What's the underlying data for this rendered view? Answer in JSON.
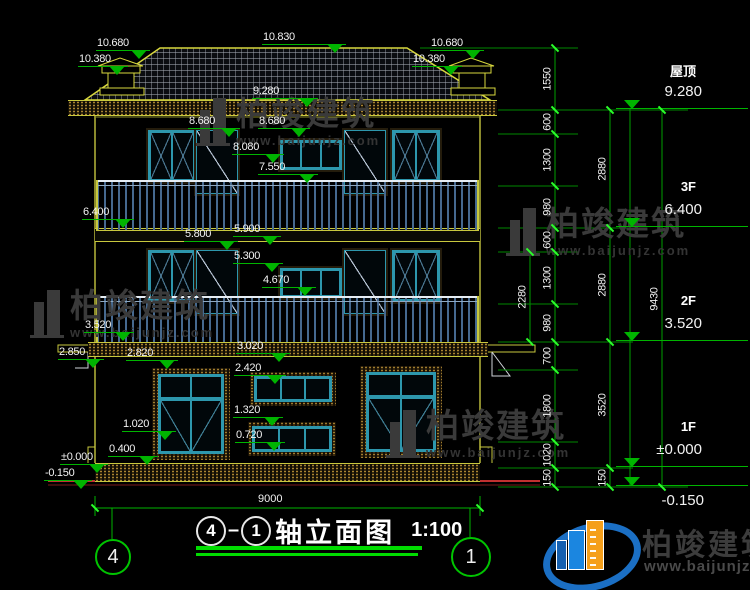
{
  "meta": {
    "drawing_type": "building elevation CAD drawing",
    "axis_from": "4",
    "axis_to": "1",
    "title_text": "轴立面图",
    "scale": "1:100",
    "bottom_overall_dim": "9000"
  },
  "colors": {
    "background": "#000000",
    "cad_yellow": "#d8d83e",
    "dim_green": "#00b400",
    "bright_green": "#2bff2b",
    "underline_green": "#00dc00",
    "window_teal": "#2d97ad",
    "rail_blue": "#46698f",
    "ground_red": "#c23030",
    "watermark_gray": "#3a3a3a",
    "logo_blue": "#1b6fc4",
    "logo_orange": "#f59f1a"
  },
  "watermark": {
    "brand": "柏竣建筑",
    "url": "www.baijunjz.com"
  },
  "logo": {
    "brand": "柏竣建筑",
    "url": "www.baijunjz.com"
  },
  "right_levels": [
    {
      "name": "屋顶",
      "value": "9.280",
      "below": "",
      "x": 616,
      "y": 108
    },
    {
      "name": "3F",
      "value": "6.400",
      "below": "",
      "x": 616,
      "y": 226
    },
    {
      "name": "2F",
      "value": "3.520",
      "below": "",
      "x": 616,
      "y": 340
    },
    {
      "name": "1F",
      "value": "±0.000",
      "below": "",
      "x": 616,
      "y": 466
    },
    {
      "name": "",
      "value": "",
      "below": "-0.150",
      "x": 616,
      "y": 485
    }
  ],
  "facade_markers": [
    {
      "label": "10.680",
      "x": 96,
      "y": 50,
      "w": 54
    },
    {
      "label": "10.380",
      "x": 78,
      "y": 66,
      "w": 50
    },
    {
      "label": "10.830",
      "x": 262,
      "y": 44,
      "w": 84
    },
    {
      "label": "10.680",
      "x": 430,
      "y": 50,
      "w": 54
    },
    {
      "label": "10.380",
      "x": 412,
      "y": 66,
      "w": 50
    },
    {
      "label": "9.280",
      "x": 252,
      "y": 98,
      "w": 66
    },
    {
      "label": "8.680",
      "x": 188,
      "y": 128,
      "w": 52
    },
    {
      "label": "8.680",
      "x": 258,
      "y": 128,
      "w": 52
    },
    {
      "label": "8.080",
      "x": 232,
      "y": 154,
      "w": 52
    },
    {
      "label": "7.550",
      "x": 258,
      "y": 174,
      "w": 60
    },
    {
      "label": "6.400",
      "x": 82,
      "y": 219,
      "w": 52
    },
    {
      "label": "5.800",
      "x": 184,
      "y": 241,
      "w": 54
    },
    {
      "label": "5.900",
      "x": 233,
      "y": 236,
      "w": 48
    },
    {
      "label": "5.300",
      "x": 233,
      "y": 263,
      "w": 50
    },
    {
      "label": "4.670",
      "x": 262,
      "y": 287,
      "w": 54
    },
    {
      "label": "3.520",
      "x": 84,
      "y": 332,
      "w": 50
    },
    {
      "label": "2.850",
      "x": 58,
      "y": 359,
      "w": 46
    },
    {
      "label": "2.820",
      "x": 126,
      "y": 360,
      "w": 52
    },
    {
      "label": "3.020",
      "x": 236,
      "y": 353,
      "w": 54
    },
    {
      "label": "2.420",
      "x": 234,
      "y": 375,
      "w": 52
    },
    {
      "label": "1.020",
      "x": 122,
      "y": 431,
      "w": 54
    },
    {
      "label": "1.320",
      "x": 233,
      "y": 417,
      "w": 50
    },
    {
      "label": "0.720",
      "x": 235,
      "y": 442,
      "w": 50
    },
    {
      "label": "0.400",
      "x": 108,
      "y": 456,
      "w": 50
    },
    {
      "label": "±0.000",
      "x": 60,
      "y": 464,
      "w": 48
    },
    {
      "label": "-0.150",
      "x": 44,
      "y": 480,
      "w": 48
    }
  ],
  "dim_segments": [
    {
      "label": "1550",
      "x": 541,
      "y": 48,
      "h": 62
    },
    {
      "label": "600",
      "x": 541,
      "y": 110,
      "h": 24
    },
    {
      "label": "1300",
      "x": 541,
      "y": 134,
      "h": 52
    },
    {
      "label": "980",
      "x": 541,
      "y": 186,
      "h": 42
    },
    {
      "label": "600",
      "x": 541,
      "y": 228,
      "h": 24
    },
    {
      "label": "1300",
      "x": 541,
      "y": 252,
      "h": 52
    },
    {
      "label": "980",
      "x": 541,
      "y": 304,
      "h": 38
    },
    {
      "label": "700",
      "x": 541,
      "y": 342,
      "h": 28
    },
    {
      "label": "1800",
      "x": 541,
      "y": 370,
      "h": 72
    },
    {
      "label": "1020",
      "x": 541,
      "y": 442,
      "h": 26
    },
    {
      "label": "150",
      "x": 541,
      "y": 468,
      "h": 19
    },
    {
      "label": "2880",
      "x": 596,
      "y": 110,
      "h": 118
    },
    {
      "label": "2880",
      "x": 596,
      "y": 228,
      "h": 114
    },
    {
      "label": "3520",
      "x": 596,
      "y": 342,
      "h": 126
    },
    {
      "label": "150",
      "x": 596,
      "y": 468,
      "h": 19
    },
    {
      "label": "9430",
      "x": 648,
      "y": 110,
      "h": 377
    },
    {
      "label": "2280",
      "x": 516,
      "y": 252,
      "h": 90
    }
  ],
  "dim_ticks": [
    {
      "x": 555,
      "y": 48
    },
    {
      "x": 555,
      "y": 110
    },
    {
      "x": 555,
      "y": 134
    },
    {
      "x": 555,
      "y": 186
    },
    {
      "x": 555,
      "y": 228
    },
    {
      "x": 555,
      "y": 252
    },
    {
      "x": 555,
      "y": 304
    },
    {
      "x": 555,
      "y": 342
    },
    {
      "x": 555,
      "y": 370
    },
    {
      "x": 555,
      "y": 442
    },
    {
      "x": 555,
      "y": 468
    },
    {
      "x": 555,
      "y": 487
    },
    {
      "x": 610,
      "y": 110
    },
    {
      "x": 610,
      "y": 228
    },
    {
      "x": 610,
      "y": 342
    },
    {
      "x": 610,
      "y": 468
    },
    {
      "x": 610,
      "y": 487
    },
    {
      "x": 662,
      "y": 110
    },
    {
      "x": 662,
      "y": 487
    },
    {
      "x": 530,
      "y": 252
    },
    {
      "x": 530,
      "y": 342
    },
    {
      "x": 95,
      "y": 508
    },
    {
      "x": 480,
      "y": 508
    }
  ],
  "bands_speckled": [
    {
      "x": 68,
      "y": 100,
      "w": 429,
      "h": 14
    },
    {
      "x": 88,
      "y": 342,
      "w": 400,
      "h": 13
    },
    {
      "x": 95,
      "y": 463,
      "w": 385,
      "h": 17
    }
  ],
  "bands_plain": [
    {
      "x": 95,
      "y": 228,
      "w": 385,
      "h": 12
    }
  ],
  "windows_casement": [
    {
      "x": 148,
      "y": 130,
      "w": 44,
      "h": 48
    },
    {
      "x": 392,
      "y": 130,
      "w": 44,
      "h": 48
    },
    {
      "x": 148,
      "y": 250,
      "w": 44,
      "h": 48
    },
    {
      "x": 392,
      "y": 250,
      "w": 44,
      "h": 48
    }
  ],
  "doors": [
    {
      "x": 196,
      "y": 130,
      "w": 40,
      "h": 62
    },
    {
      "x": 344,
      "y": 130,
      "w": 40,
      "h": 62
    },
    {
      "x": 196,
      "y": 250,
      "w": 40,
      "h": 62
    },
    {
      "x": 344,
      "y": 250,
      "w": 40,
      "h": 62
    }
  ],
  "windows_small3": [
    {
      "x": 280,
      "y": 140,
      "w": 58,
      "h": 26
    },
    {
      "x": 280,
      "y": 268,
      "w": 58,
      "h": 26
    }
  ],
  "windows_1f_large": [
    {
      "x": 152,
      "y": 368,
      "w": 66,
      "h": 80
    },
    {
      "x": 360,
      "y": 366,
      "w": 70,
      "h": 80
    }
  ],
  "windows_1f_small": [
    {
      "x": 250,
      "y": 372,
      "w": 78,
      "h": 26
    },
    {
      "x": 248,
      "y": 422,
      "w": 80,
      "h": 26
    }
  ],
  "railings": [
    {
      "x": 97,
      "y": 180,
      "w": 381,
      "h": 48
    },
    {
      "x": 97,
      "y": 296,
      "w": 381,
      "h": 44
    }
  ],
  "watermarks": [
    {
      "x": 196,
      "y": 96
    },
    {
      "x": 506,
      "y": 206
    },
    {
      "x": 30,
      "y": 288
    },
    {
      "x": 386,
      "y": 408
    }
  ]
}
